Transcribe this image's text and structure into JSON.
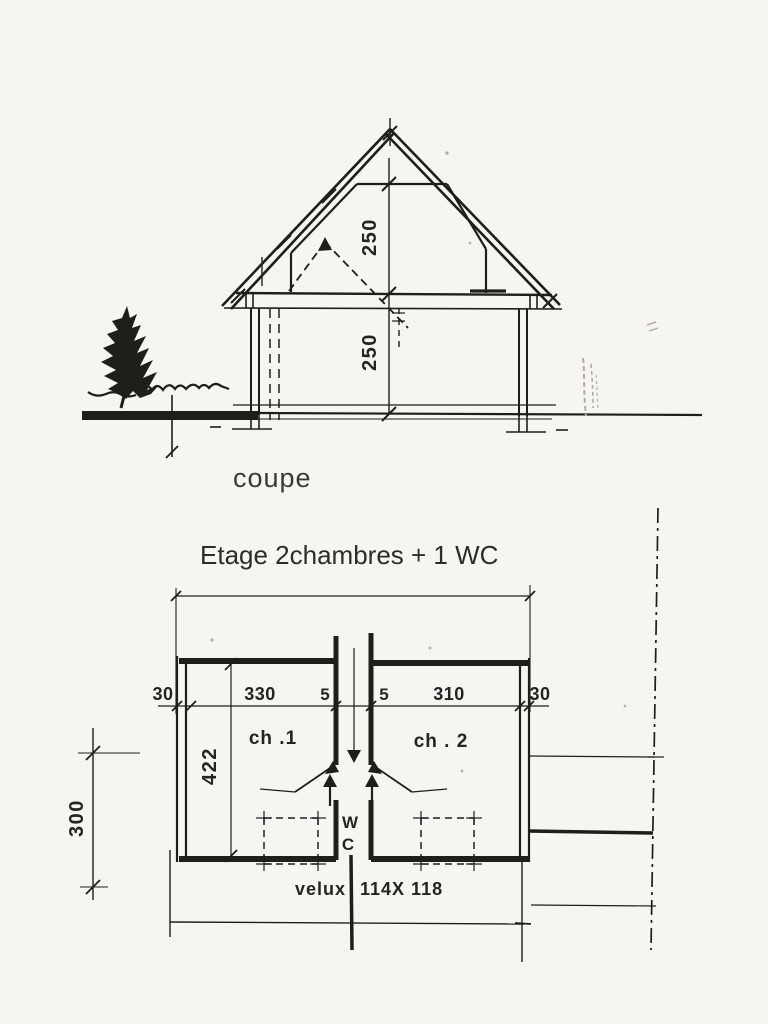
{
  "colors": {
    "paper": "#f6f5f2",
    "ink": "#201e1b",
    "caption_text": "#3b3935"
  },
  "section": {
    "caption": "coupe",
    "dim_attic_height": "250",
    "dim_floor_height": "250"
  },
  "plan": {
    "title": "Etage  2chambres + 1 WC",
    "dims_top": [
      "30",
      "330",
      "5",
      "5",
      "310",
      "30"
    ],
    "dim_depth": "422",
    "dim_left": "300",
    "room_1": "ch .1",
    "room_2": "ch . 2",
    "wc_line1": "W",
    "wc_line2": "C",
    "velux_word": "velux",
    "velux_size": "114X 118"
  }
}
